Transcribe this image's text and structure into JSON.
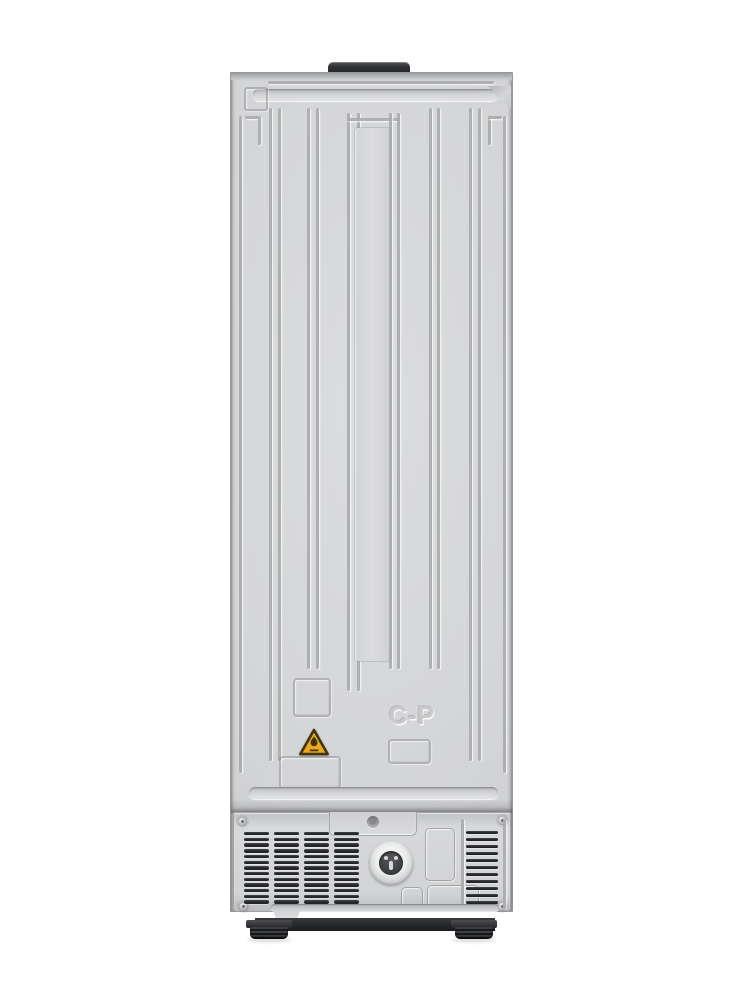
{
  "meta": {
    "description": "Rear view product photo of a freestanding refrigerator",
    "background": "#ffffff"
  },
  "colors": {
    "bg": "#ffffff",
    "panel": "#d3d4d6",
    "panel_light": "#dcdddf",
    "panel_edge": "#96979a",
    "groove": "#aaabad",
    "hinge": "#303134",
    "vent_panel": "#d7d8da",
    "vent_slot": "#232427",
    "plinth": "#2b2c2e",
    "foot": "#18191b",
    "warning_yellow": "#eaa722",
    "warning_dark": "#42350c"
  },
  "back_panel": {
    "embossed_text": "C-P"
  },
  "warning_label": {
    "symbol": "flame-in-triangle"
  },
  "vent_grille": {
    "left_columns": 4,
    "left_slats_per_column": 13,
    "right_columns": 1,
    "right_slats_per_column": 11
  },
  "hardware": {
    "screw_count": 4,
    "feet_count": 2
  }
}
